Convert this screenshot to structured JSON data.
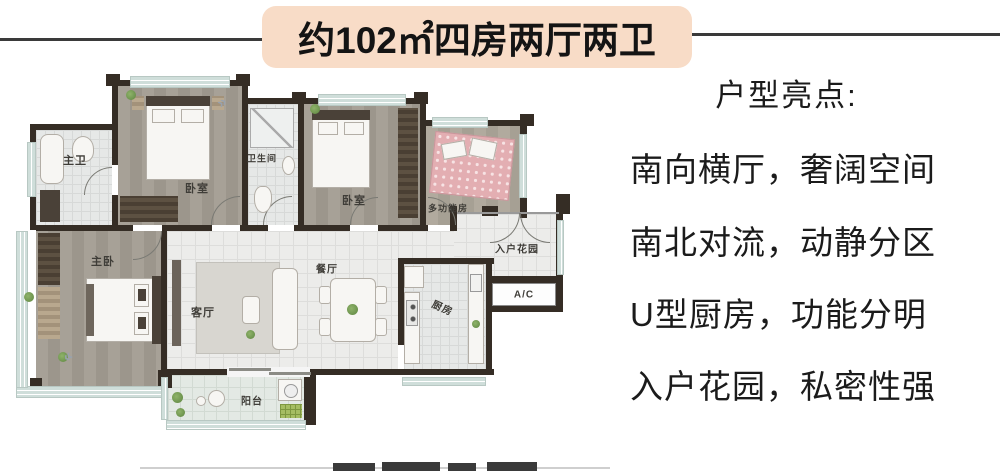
{
  "title": {
    "text": "约102㎡四房两厅两卫"
  },
  "highlights": {
    "heading": "户型亮点:",
    "lines": [
      "南向横厅，奢阔空间",
      "南北对流，动静分区",
      "U型厨房，功能分明",
      "入户花园，私密性强"
    ]
  },
  "floorplan": {
    "rooms": {
      "master_bath": "主卫",
      "bedroom1": "卧室",
      "bathroom": "卫生间",
      "bedroom2": "卧室",
      "multi_room": "多功能房",
      "entry_garden": "入户花园",
      "ac_platform": "A/C",
      "kitchen": "厨房",
      "dining": "餐厅",
      "living": "客厅",
      "master_bedroom": "主卧",
      "balcony": "阳台"
    },
    "decor": {
      "chevron": "»"
    }
  },
  "colors": {
    "title_bg": "#f8dcc7",
    "wall": "#352d25",
    "text": "#1a1a1a"
  }
}
